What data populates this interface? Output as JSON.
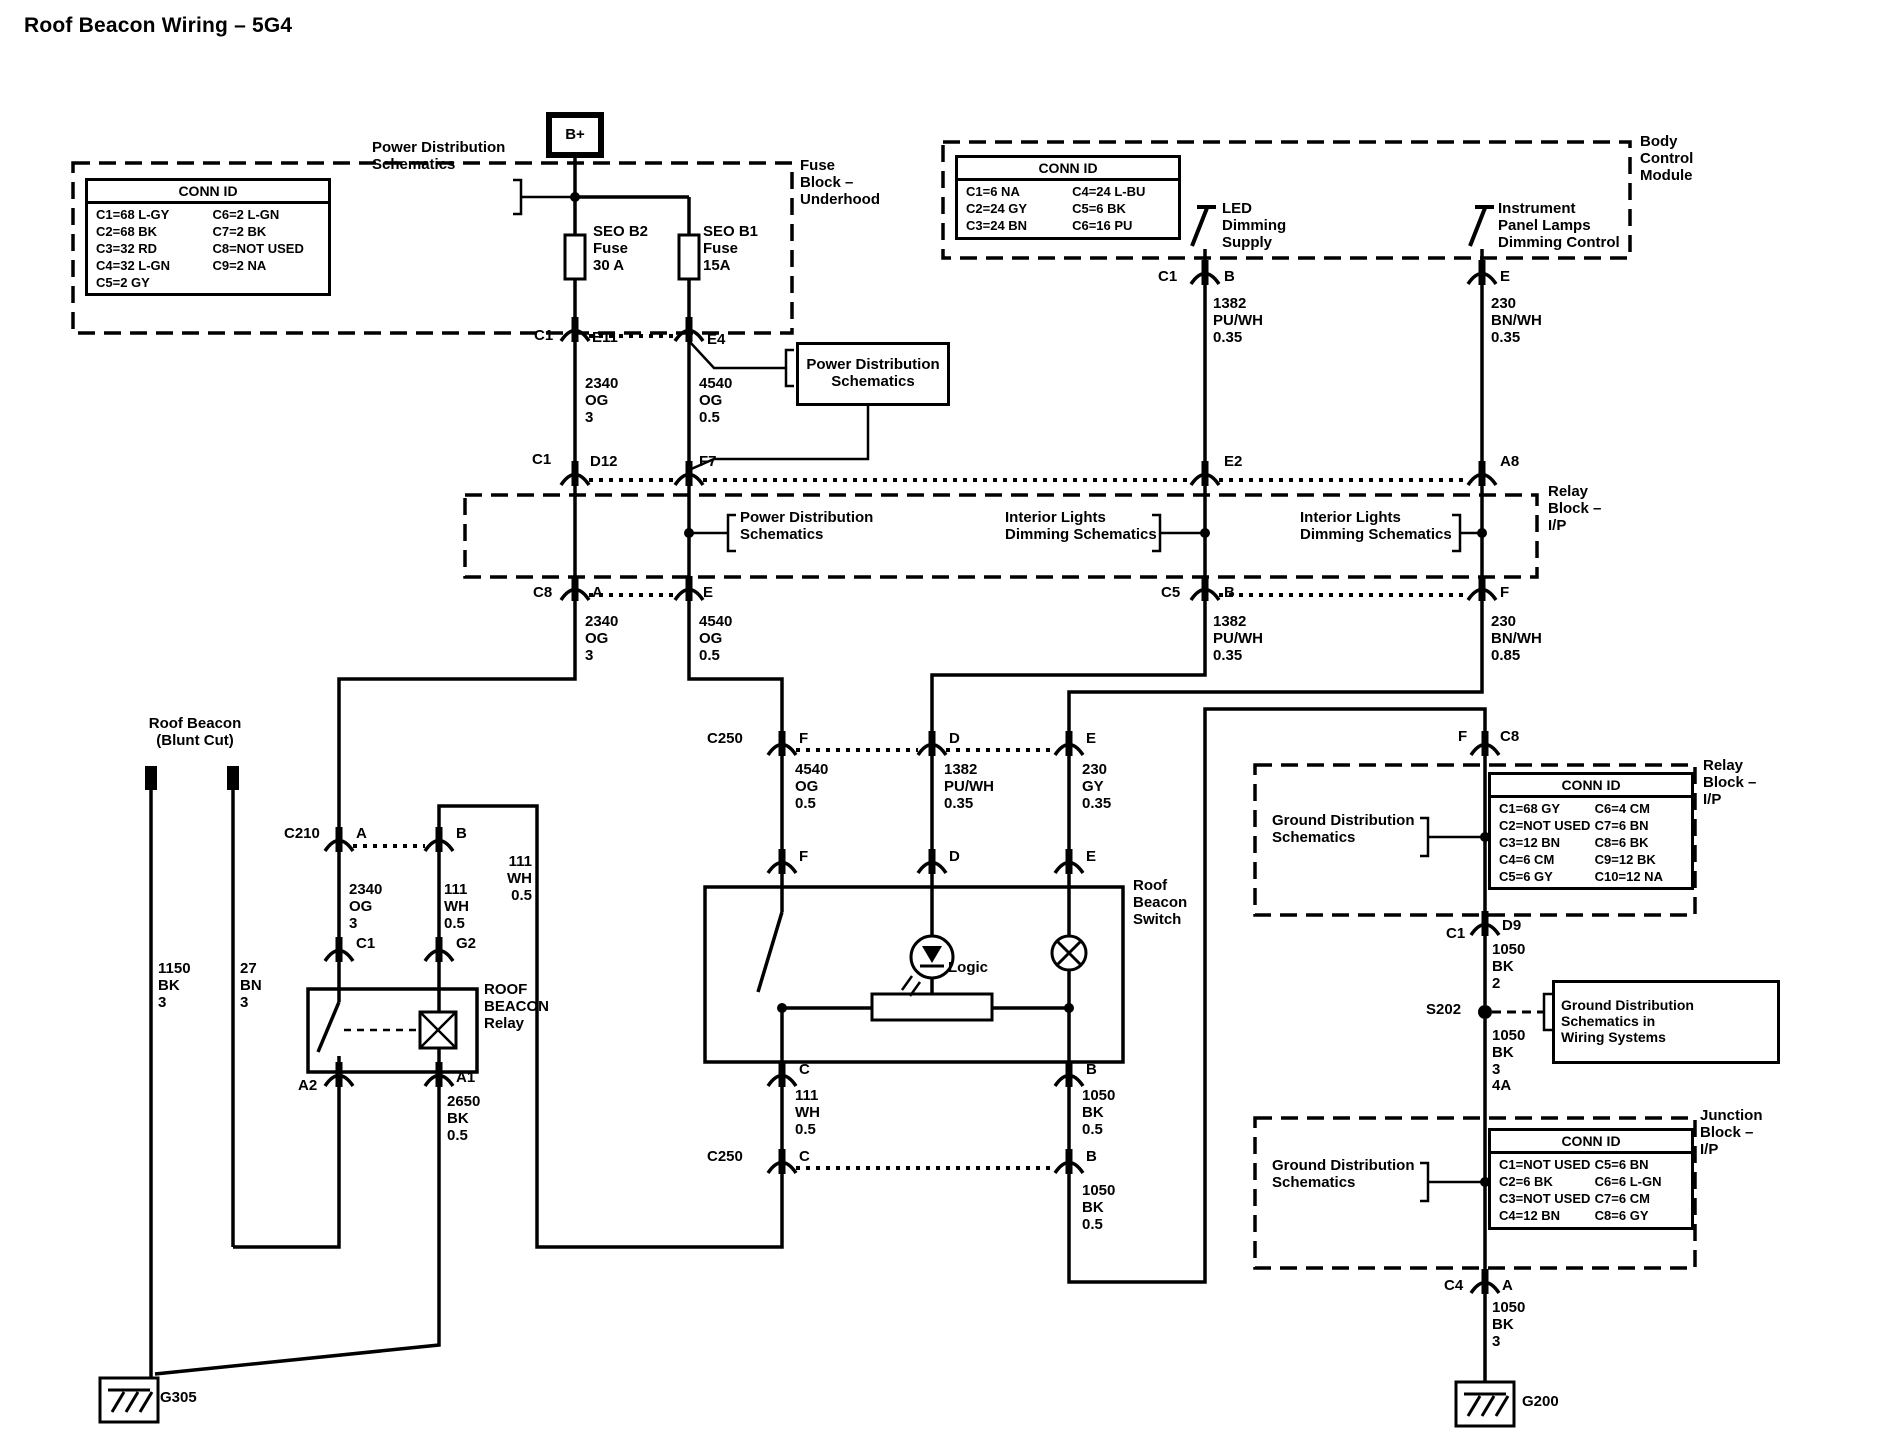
{
  "title": "Roof Beacon Wiring – 5G4",
  "conn_boxes": {
    "fuse_underhood": {
      "header": "CONN ID",
      "rows": [
        [
          "C1=68 L-GY",
          "C6=2 L-GN"
        ],
        [
          "C2=68 BK",
          "C7=2 BK"
        ],
        [
          "C3=32 RD",
          "C8=NOT USED"
        ],
        [
          "C4=32 L-GN",
          "C9=2 NA"
        ],
        [
          "C5=2 GY",
          ""
        ]
      ]
    },
    "bcm": {
      "header": "CONN ID",
      "rows": [
        [
          "C1=6 NA",
          "C4=24 L-BU"
        ],
        [
          "C2=24 GY",
          "C5=6 BK"
        ],
        [
          "C3=24 BN",
          "C6=16 PU"
        ]
      ]
    },
    "relay_ip": {
      "header": "CONN ID",
      "rows": [
        [
          "C1=68 GY",
          "C6=4 CM"
        ],
        [
          "C2=NOT USED",
          "C7=6 BN"
        ],
        [
          "C3=12 BN",
          "C8=6 BK"
        ],
        [
          "C4=6 CM",
          "C9=12 BK"
        ],
        [
          "C5=6 GY",
          "C10=12 NA"
        ]
      ]
    },
    "junction_ip": {
      "header": "CONN ID",
      "rows": [
        [
          "C1=NOT USED",
          "C5=6 BN"
        ],
        [
          "C2=6 BK",
          "C6=6 L-GN"
        ],
        [
          "C3=NOT USED",
          "C7=6 CM"
        ],
        [
          "C4=12 BN",
          "C8=6 GY"
        ]
      ]
    }
  },
  "labels": {
    "title": "Roof Beacon Wiring – 5G4",
    "b_plus": "B+",
    "pds_top": "Power Distribution\nSchematics",
    "seo_b2": "SEO B2\nFuse\n30 A",
    "seo_b1": "SEO B1\nFuse\n15A",
    "fuse_block": "Fuse\nBlock –\nUnderhood",
    "conn_c1_top": "C1",
    "e11": "E11",
    "e4": "E4",
    "pds_box": "Power Distribution\nSchematics",
    "w2340_1": "2340\nOG\n3",
    "w4540_1": "4540\nOG\n0.5",
    "conn_c1_mid": "C1",
    "d12": "D12",
    "f7": "F7",
    "led_supply": "LED\nDimming\nSupply",
    "ipl_control": "Instrument\nPanel Lamps\nDimming Control",
    "bcm": "Body\nControl\nModule",
    "bcm_c1": "C1",
    "bcm_b": "B",
    "bcm_e": "E",
    "w1382_1": "1382\nPU/WH\n0.35",
    "w230_1": "230\nBN/WH\n0.35",
    "e2": "E2",
    "a8": "A8",
    "relay_block": "Relay\nBlock –\nI/P",
    "pds_relay": "Power Distribution\nSchematics",
    "ilds_1": "Interior Lights\nDimming Schematics",
    "ilds_2": "Interior Lights\nDimming Schematics",
    "c8_lbl": "C8",
    "a_lbl": "A",
    "e_lbl": "E",
    "c5_lbl": "C5",
    "b_lbl": "B",
    "f_lbl": "F",
    "w2340_2": "2340\nOG\n3",
    "w4540_2": "4540\nOG\n0.5",
    "w1382_2": "1382\nPU/WH\n0.35",
    "w230_2": "230\nBN/WH\n0.85",
    "c250_1": "C250",
    "c250_f1": "F",
    "c250_d1": "D",
    "c250_e1": "E",
    "w4540_3": "4540\nOG\n0.5",
    "w1382_3": "1382\nPU/WH\n0.35",
    "w230gy": "230\nGY\n0.35",
    "sw_f": "F",
    "sw_d": "D",
    "sw_e": "E",
    "rbs": "Roof\nBeacon\nSwitch",
    "logic": "Logic",
    "sw_c": "C",
    "sw_b": "B",
    "w111_2": "111\nWH\n0.5",
    "w1050_1": "1050\nBK\n0.5",
    "c250_2": "C250",
    "c250_c2": "C",
    "c250_b2": "B",
    "w1050_2": "1050\nBK\n0.5",
    "w111_3": "111\nWH\n0.5",
    "blunt": "Roof Beacon\n(Blunt Cut)",
    "w1150": "1150\nBK\n3",
    "w27": "27\nBN\n3",
    "c210": "C210",
    "c210_a": "A",
    "c210_b": "B",
    "w2340_3": "2340\nOG\n3",
    "w111_1": "111\nWH\n0.5",
    "rc1": "C1",
    "g2": "G2",
    "relay_name": "ROOF\nBEACON\nRelay",
    "a2": "A2",
    "a1": "A1",
    "w2650": "2650\nBK\n0.5",
    "g305": "G305",
    "f_top": "F",
    "c8_top": "C8",
    "gds_1": "Ground Distribution\nSchematics",
    "relay_ip": "Relay\nBlock –\nI/P",
    "d9_c1": "C1",
    "d9": "D9",
    "w1050_bk2": "1050\nBK\n2",
    "s202": "S202",
    "gds_ws": "Ground Distribution\nSchematics in\nWiring Systems",
    "w1050_34a": "1050\nBK\n3\n4A",
    "gds_2": "Ground Distribution\nSchematics",
    "junction_ip": "Junction\nBlock –\nI/P",
    "c4_lbl": "C4",
    "c4_a": "A",
    "w1050_3": "1050\nBK\n3",
    "g200": "G200"
  }
}
